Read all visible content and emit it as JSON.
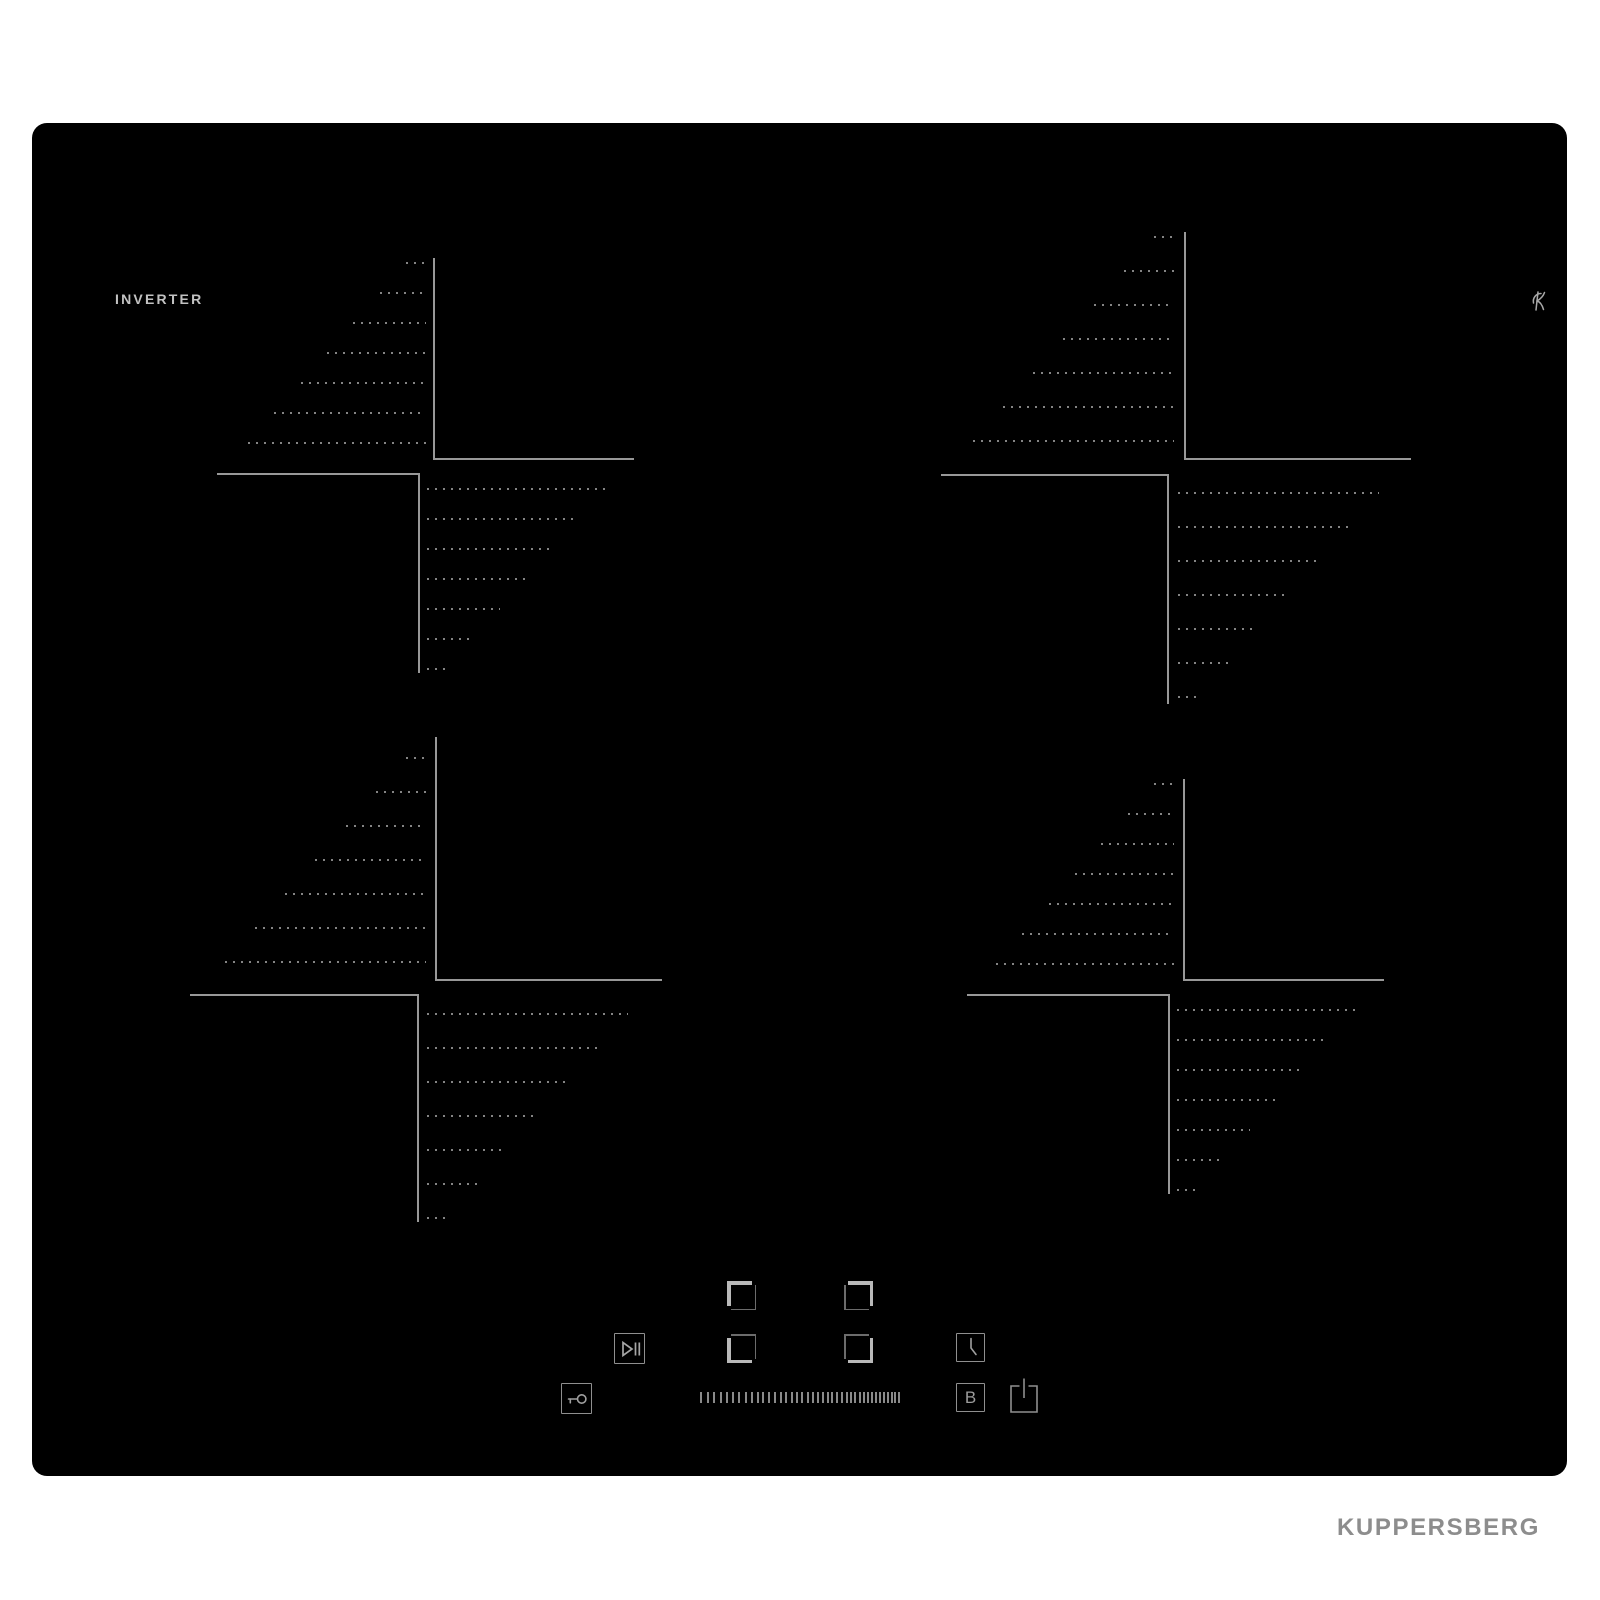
{
  "device": {
    "type_label": "INVERTER",
    "brand": "KUPPERSBERG",
    "logo_icon": "kuppersberg-k-monogram"
  },
  "colors": {
    "background": "#ffffff",
    "surface": "#000000",
    "marking_line": "#989898",
    "marking_dots": "#848484",
    "control_line": "#8f8f8f",
    "feature_text": "#c2c2c2",
    "brand_text": "#8d8d8d"
  },
  "zones": [
    {
      "position": "rear-left"
    },
    {
      "position": "rear-right"
    },
    {
      "position": "front-left"
    },
    {
      "position": "front-right"
    }
  ],
  "controls": {
    "pause": {
      "icon": "play-pause-icon"
    },
    "selectors": [
      {
        "zone": "rear-left",
        "icon": "corner-top-left-icon"
      },
      {
        "zone": "rear-right",
        "icon": "corner-top-right-icon"
      },
      {
        "zone": "front-left",
        "icon": "corner-bottom-left-icon"
      },
      {
        "zone": "front-right",
        "icon": "corner-bottom-right-icon"
      }
    ],
    "timer": {
      "icon": "clock-icon"
    },
    "lock": {
      "icon": "key-icon"
    },
    "power_slider": {
      "icon": "power-level-slider",
      "ticks": 40
    },
    "booster": {
      "label": "B"
    },
    "power": {
      "icon": "power-icon"
    }
  }
}
